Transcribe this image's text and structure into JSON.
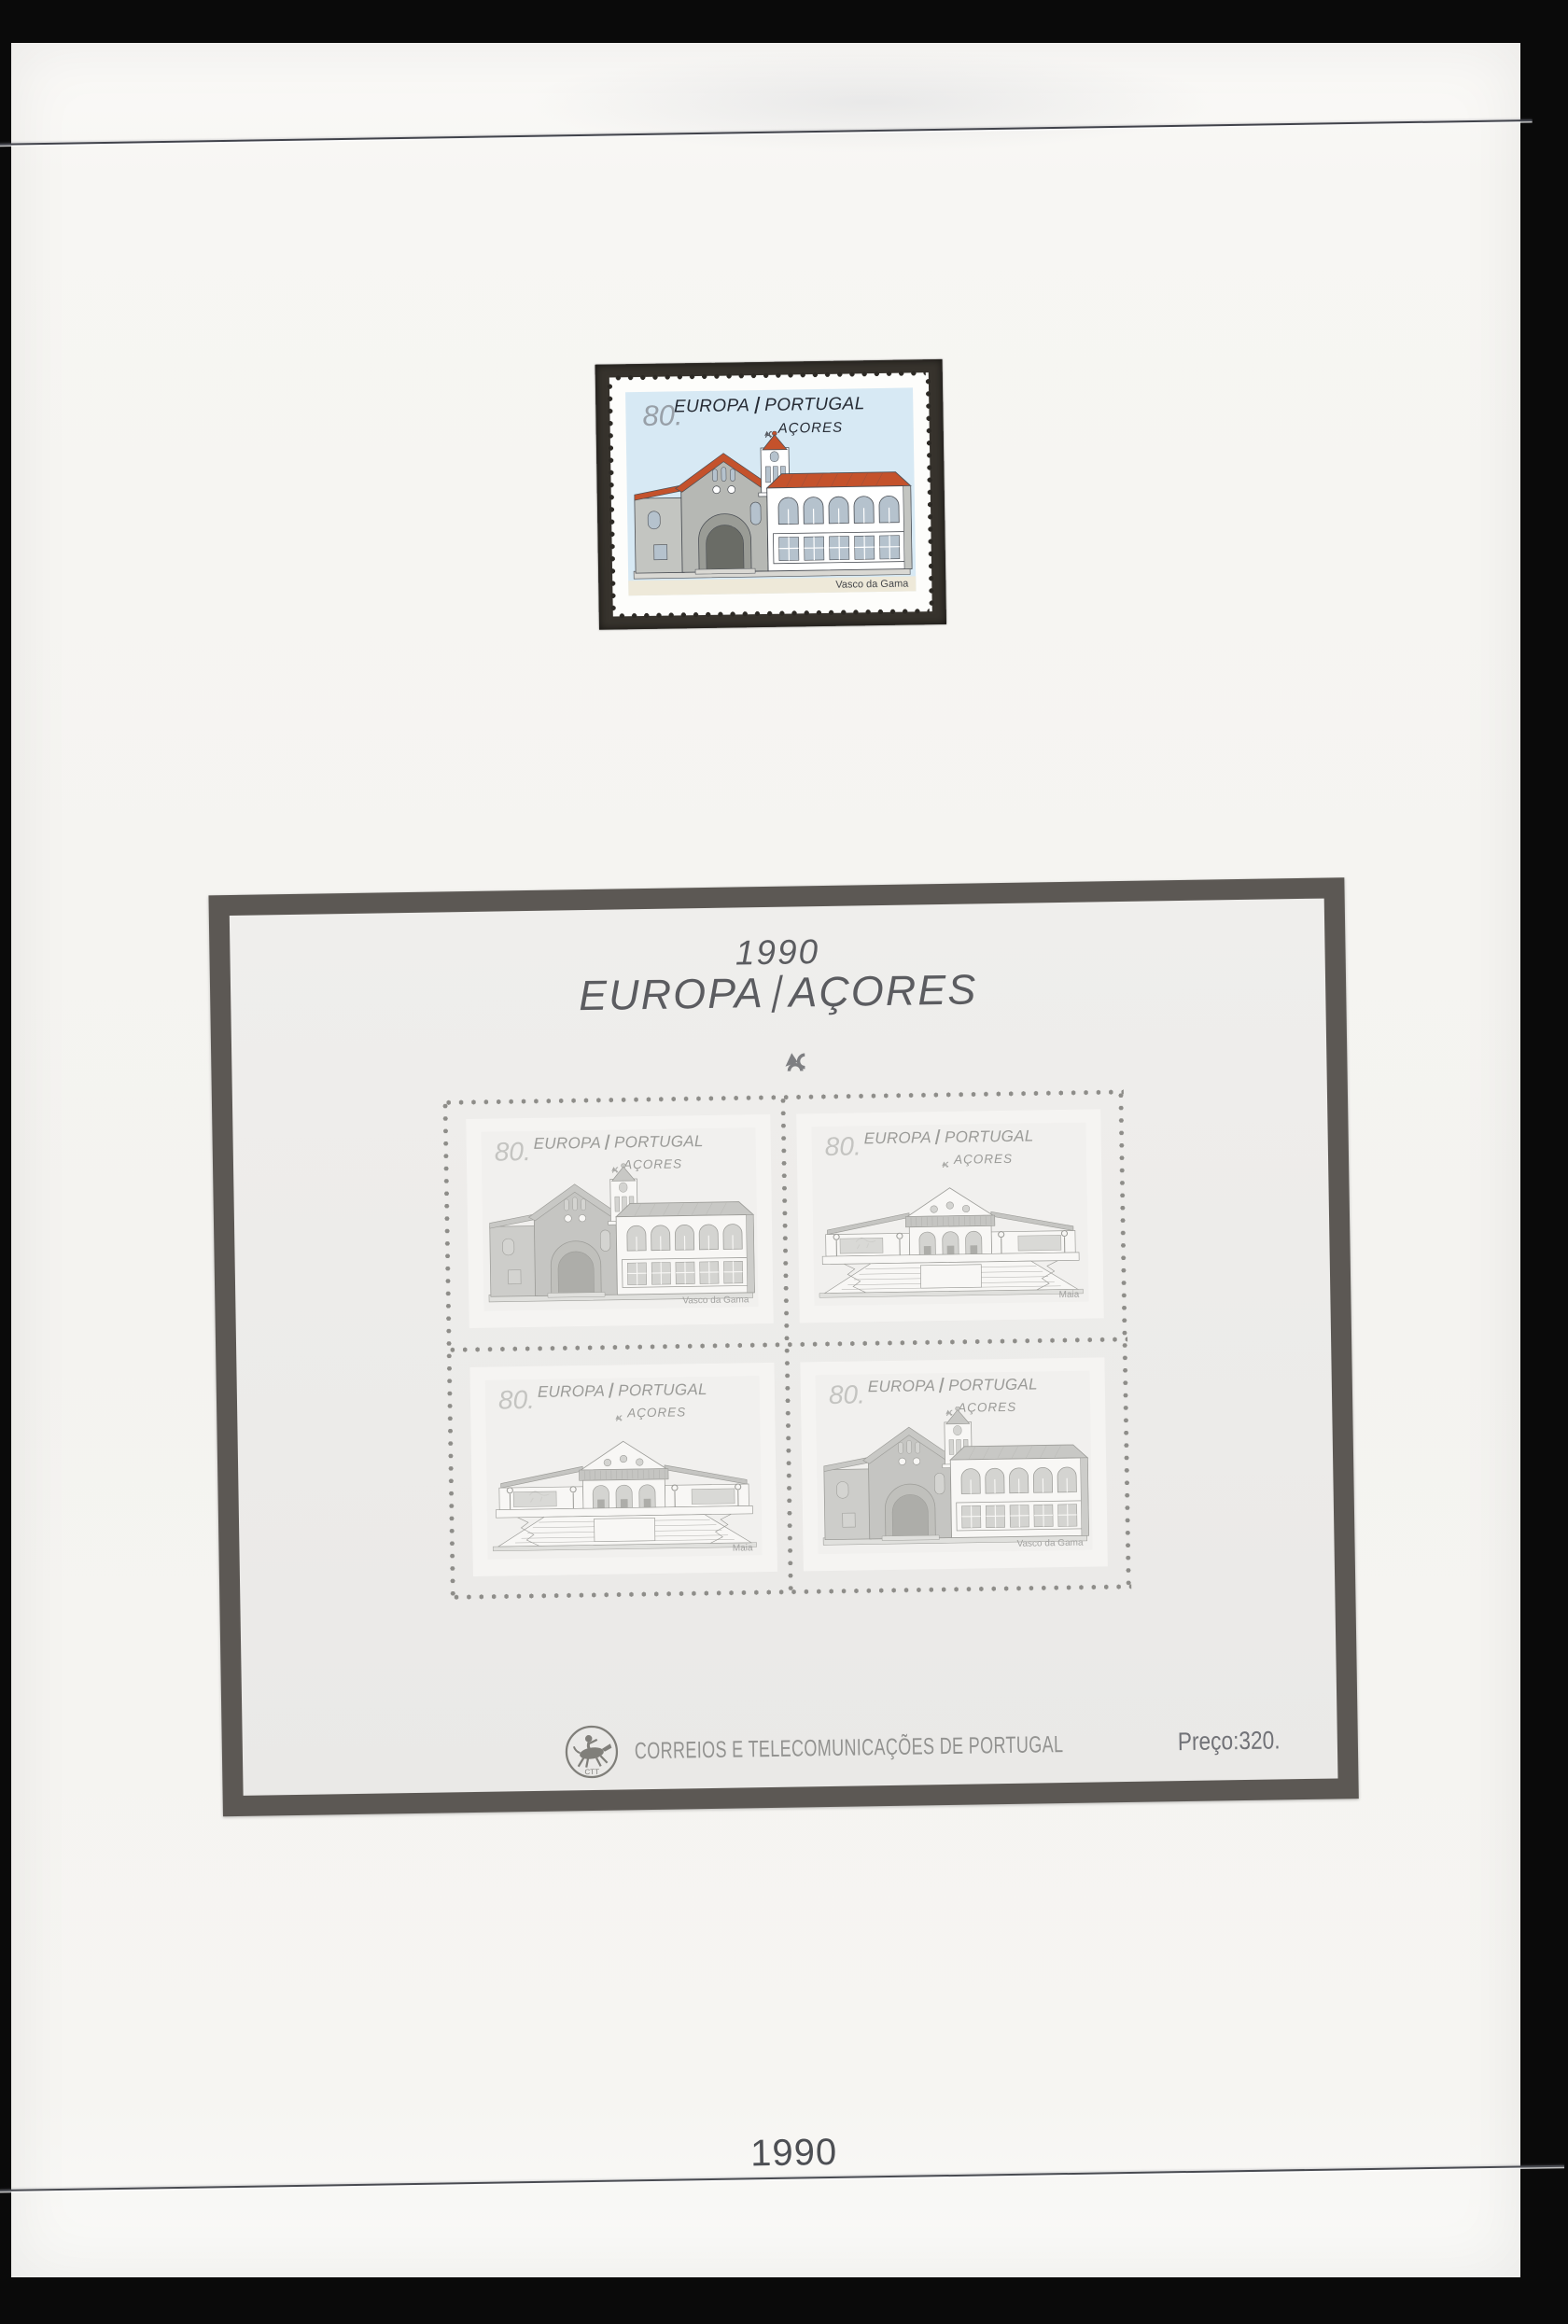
{
  "page": {
    "year_label": "1990"
  },
  "top_stamp": {
    "denomination": "80.",
    "country_left": "EUROPA",
    "country_right": "PORTUGAL",
    "region": "AÇORES",
    "caption": "Vasco da Gama"
  },
  "souvenir_sheet": {
    "year": "1990",
    "title_left": "EUROPA",
    "title_right": "AÇORES",
    "stamps": [
      {
        "denomination": "80.",
        "country_left": "EUROPA",
        "country_right": "PORTUGAL",
        "region": "AÇORES",
        "caption": "Vasco da Gama"
      },
      {
        "denomination": "80.",
        "country_left": "EUROPA",
        "country_right": "PORTUGAL",
        "region": "AÇORES",
        "caption": "Maia"
      },
      {
        "denomination": "80.",
        "country_left": "EUROPA",
        "country_right": "PORTUGAL",
        "region": "AÇORES",
        "caption": "Maia"
      },
      {
        "denomination": "80.",
        "country_left": "EUROPA",
        "country_right": "PORTUGAL",
        "region": "AÇORES",
        "caption": "Vasco da Gama"
      }
    ],
    "footer": {
      "publisher": "CORREIOS E TELECOMUNICAÇÕES DE PORTUGAL",
      "price": "Preço:320."
    }
  },
  "icons": {
    "cept_emblem": "cept-europa-emblem",
    "ctt_rider": "ctt-horse-rider-emblem"
  },
  "colors": {
    "photo_background": "#0a0a0a",
    "album_page": "#f5f4f1",
    "stamp_mount_black": "#37332d",
    "sheet_mount_gray": "#5c5854",
    "sheet_paper": "#ecebe9",
    "stamp_sky_blue": "#d7e9f4",
    "stamp_roof_orange": "#c4522c"
  }
}
